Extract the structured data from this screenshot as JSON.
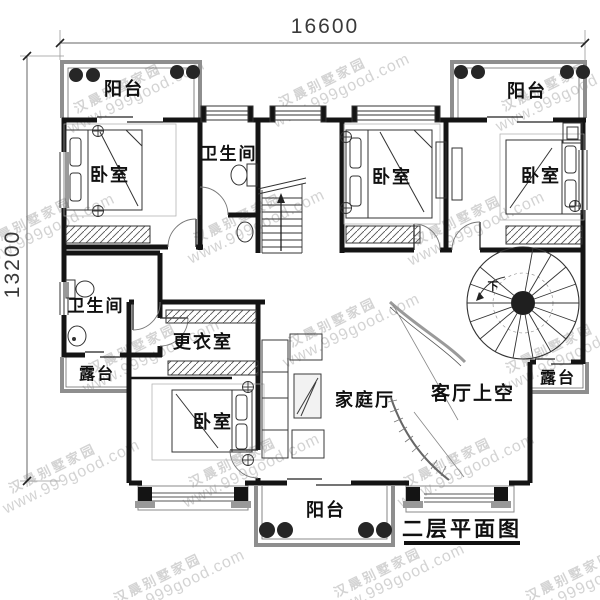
{
  "title_block": {
    "title": "二层平面图"
  },
  "dimensions": {
    "top": "16600",
    "left": "13200"
  },
  "rooms": {
    "balcony_top_left": "阳台",
    "balcony_top_right": "阳台",
    "balcony_bottom": "阳台",
    "bedroom_top_left": "卧室",
    "bedroom_top_middle": "卧室",
    "bedroom_top_right": "卧室",
    "bedroom_bottom": "卧室",
    "bathroom_top": "卫生间",
    "bathroom_left": "卫生间",
    "dressing_room": "更衣室",
    "family_hall": "家庭厅",
    "living_room_void": "客厅上空",
    "terrace_left": "露台",
    "terrace_right": "露台"
  },
  "stair": {
    "down_label": "下"
  },
  "watermark": {
    "line1": "汉晨别墅家园",
    "line2": "www.999good.com"
  },
  "colors": {
    "wall": "#141414",
    "railing": "#8e8e8e",
    "column": "#262626",
    "dimension": "#3a3a3a",
    "watermark": "#b0b0b0",
    "background": "#ffffff"
  }
}
